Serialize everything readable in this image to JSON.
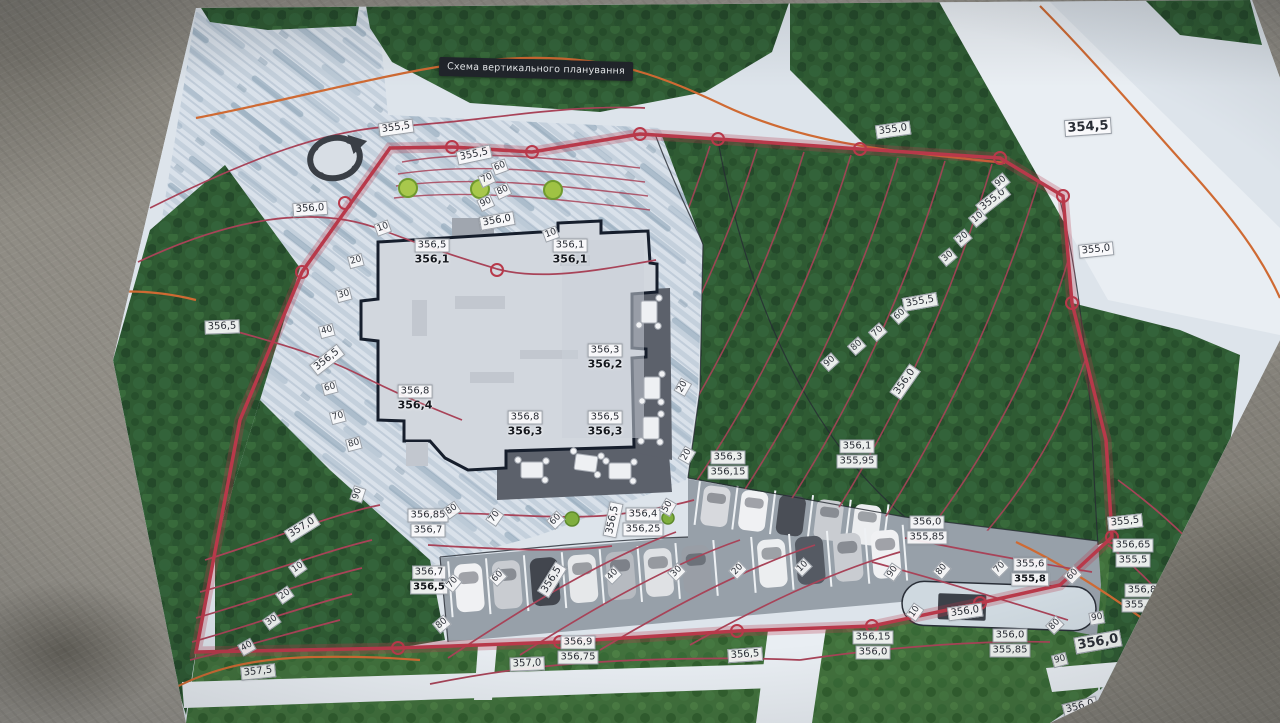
{
  "title": "Схема вертикального планування",
  "colors": {
    "boundary_red": "#b8394a",
    "design_contour_red": "#a84358",
    "existing_contour_orange": "#cf6a33",
    "label_background": "#f7f8f9",
    "label_text": "#2a2e36",
    "building_fill": "#d2d7de",
    "forest_green": "#2f5b33"
  },
  "map": {
    "contour_labels": [
      {
        "text": "355,5",
        "x": 396,
        "y": 128,
        "r": -8
      },
      {
        "text": "355,0",
        "x": 893,
        "y": 130,
        "r": -8
      },
      {
        "text": "354,5",
        "x": 1088,
        "y": 127,
        "r": -4,
        "big": true
      },
      {
        "text": "355,0",
        "x": 993,
        "y": 200,
        "r": -38
      },
      {
        "text": "355,0",
        "x": 1096,
        "y": 250,
        "r": -6
      },
      {
        "text": "355,5",
        "x": 920,
        "y": 302,
        "r": -10
      },
      {
        "text": "356,5",
        "x": 222,
        "y": 327,
        "r": -2
      },
      {
        "text": "355,5",
        "x": 474,
        "y": 155,
        "r": -12
      },
      {
        "text": "356,0",
        "x": 310,
        "y": 209,
        "r": -4
      },
      {
        "text": "356,0",
        "x": 497,
        "y": 221,
        "r": -10
      },
      {
        "text": "356,5",
        "x": 327,
        "y": 360,
        "r": -38
      },
      {
        "text": "357,0",
        "x": 302,
        "y": 528,
        "r": -32
      },
      {
        "text": "357,5",
        "x": 258,
        "y": 672,
        "r": -6
      },
      {
        "text": "357,0",
        "x": 527,
        "y": 664,
        "r": -2
      },
      {
        "text": "356,5",
        "x": 745,
        "y": 655,
        "r": -4
      },
      {
        "text": "356,0",
        "x": 965,
        "y": 612,
        "r": -8
      },
      {
        "text": "356,0",
        "x": 1098,
        "y": 642,
        "r": -10,
        "big": true
      },
      {
        "text": "356,0",
        "x": 1080,
        "y": 707,
        "r": -14
      },
      {
        "text": "355,5",
        "x": 1125,
        "y": 522,
        "r": -6
      },
      {
        "text": "356,5",
        "x": 552,
        "y": 580,
        "r": -58
      },
      {
        "text": "356,5",
        "x": 613,
        "y": 520,
        "r": -78
      },
      {
        "text": "356,0",
        "x": 905,
        "y": 382,
        "r": -55
      }
    ],
    "spot_elevations": [
      {
        "top": "356,5",
        "bottom": "356,1",
        "x": 432,
        "y": 252,
        "style": "building"
      },
      {
        "top": "356,1",
        "bottom": "356,1",
        "x": 570,
        "y": 252,
        "style": "building"
      },
      {
        "top": "356,3",
        "bottom": "356,2",
        "x": 605,
        "y": 357,
        "style": "building"
      },
      {
        "top": "356,8",
        "bottom": "356,4",
        "x": 415,
        "y": 398,
        "style": "building"
      },
      {
        "top": "356,8",
        "bottom": "356,3",
        "x": 525,
        "y": 424,
        "style": "building"
      },
      {
        "top": "356,5",
        "bottom": "356,3",
        "x": 605,
        "y": 424,
        "style": "building"
      },
      {
        "top": "356,3",
        "bottom": "356,15",
        "x": 728,
        "y": 465,
        "style": "ground"
      },
      {
        "top": "356,1",
        "bottom": "355,95",
        "x": 857,
        "y": 454,
        "style": "ground"
      },
      {
        "top": "356,0",
        "bottom": "355,85",
        "x": 927,
        "y": 530,
        "style": "ground"
      },
      {
        "top": "356,4",
        "bottom": "356,25",
        "x": 643,
        "y": 522,
        "style": "ground"
      },
      {
        "top": "356,85",
        "bottom": "356,7",
        "x": 428,
        "y": 523,
        "style": "ground"
      },
      {
        "top": "356,7",
        "bottom": "356,5",
        "x": 429,
        "y": 580,
        "style": "ground",
        "bold": true
      },
      {
        "top": "356,9",
        "bottom": "356,75",
        "x": 578,
        "y": 650,
        "style": "ground"
      },
      {
        "top": "356,15",
        "bottom": "356,0",
        "x": 873,
        "y": 645,
        "style": "ground"
      },
      {
        "top": "356,0",
        "bottom": "355,85",
        "x": 1010,
        "y": 643,
        "style": "ground"
      },
      {
        "top": "355,6",
        "bottom": "355,8",
        "x": 1030,
        "y": 572,
        "style": "ground",
        "bold": true
      },
      {
        "top": "356,65",
        "bottom": "355,5",
        "x": 1133,
        "y": 553,
        "style": "ground"
      },
      {
        "top": "356,8",
        "bottom": "355,65",
        "x": 1142,
        "y": 598,
        "style": "ground"
      }
    ],
    "slope_marks": [
      {
        "t": "60",
        "x": 500,
        "y": 167,
        "r": -20
      },
      {
        "t": "70",
        "x": 487,
        "y": 179,
        "r": -25
      },
      {
        "t": "80",
        "x": 503,
        "y": 191,
        "r": -25
      },
      {
        "t": "90",
        "x": 486,
        "y": 203,
        "r": -25
      },
      {
        "t": "10",
        "x": 383,
        "y": 228,
        "r": -20
      },
      {
        "t": "10",
        "x": 551,
        "y": 234,
        "r": -20
      },
      {
        "t": "90",
        "x": 1001,
        "y": 182,
        "r": -40
      },
      {
        "t": "10",
        "x": 978,
        "y": 218,
        "r": -40
      },
      {
        "t": "20",
        "x": 963,
        "y": 238,
        "r": -40
      },
      {
        "t": "30",
        "x": 948,
        "y": 257,
        "r": -40
      },
      {
        "t": "60",
        "x": 900,
        "y": 315,
        "r": -42
      },
      {
        "t": "70",
        "x": 878,
        "y": 332,
        "r": -42
      },
      {
        "t": "80",
        "x": 857,
        "y": 346,
        "r": -42
      },
      {
        "t": "90",
        "x": 830,
        "y": 362,
        "r": -42
      },
      {
        "t": "20",
        "x": 683,
        "y": 387,
        "r": -60
      },
      {
        "t": "20",
        "x": 687,
        "y": 455,
        "r": -60
      },
      {
        "t": "20",
        "x": 356,
        "y": 261,
        "r": -15
      },
      {
        "t": "30",
        "x": 344,
        "y": 295,
        "r": -15
      },
      {
        "t": "40",
        "x": 327,
        "y": 331,
        "r": -15
      },
      {
        "t": "60",
        "x": 330,
        "y": 388,
        "r": -15
      },
      {
        "t": "70",
        "x": 338,
        "y": 417,
        "r": -15
      },
      {
        "t": "80",
        "x": 354,
        "y": 444,
        "r": -15
      },
      {
        "t": "90",
        "x": 358,
        "y": 494,
        "r": -72
      },
      {
        "t": "10",
        "x": 298,
        "y": 568,
        "r": -35
      },
      {
        "t": "20",
        "x": 285,
        "y": 595,
        "r": -35
      },
      {
        "t": "30",
        "x": 272,
        "y": 621,
        "r": -35
      },
      {
        "t": "40",
        "x": 247,
        "y": 647,
        "r": -30
      },
      {
        "t": "80",
        "x": 452,
        "y": 510,
        "r": -35
      },
      {
        "t": "70",
        "x": 495,
        "y": 517,
        "r": -55
      },
      {
        "t": "60",
        "x": 556,
        "y": 520,
        "r": -45
      },
      {
        "t": "50",
        "x": 668,
        "y": 507,
        "r": -60
      },
      {
        "t": "70",
        "x": 453,
        "y": 583,
        "r": -50
      },
      {
        "t": "60",
        "x": 498,
        "y": 577,
        "r": -45
      },
      {
        "t": "40",
        "x": 613,
        "y": 575,
        "r": -45
      },
      {
        "t": "30",
        "x": 677,
        "y": 572,
        "r": -45
      },
      {
        "t": "20",
        "x": 738,
        "y": 570,
        "r": -45
      },
      {
        "t": "10",
        "x": 803,
        "y": 567,
        "r": -45
      },
      {
        "t": "80",
        "x": 442,
        "y": 624,
        "r": -40
      },
      {
        "t": "90",
        "x": 893,
        "y": 572,
        "r": -55
      },
      {
        "t": "80",
        "x": 942,
        "y": 570,
        "r": -50
      },
      {
        "t": "70",
        "x": 1000,
        "y": 568,
        "r": -45
      },
      {
        "t": "60",
        "x": 1073,
        "y": 575,
        "r": -45
      },
      {
        "t": "10",
        "x": 915,
        "y": 612,
        "r": -55
      },
      {
        "t": "80",
        "x": 1055,
        "y": 625,
        "r": -45
      },
      {
        "t": "90",
        "x": 1097,
        "y": 618,
        "r": -10
      },
      {
        "t": "90",
        "x": 1060,
        "y": 660,
        "r": -15
      }
    ]
  }
}
